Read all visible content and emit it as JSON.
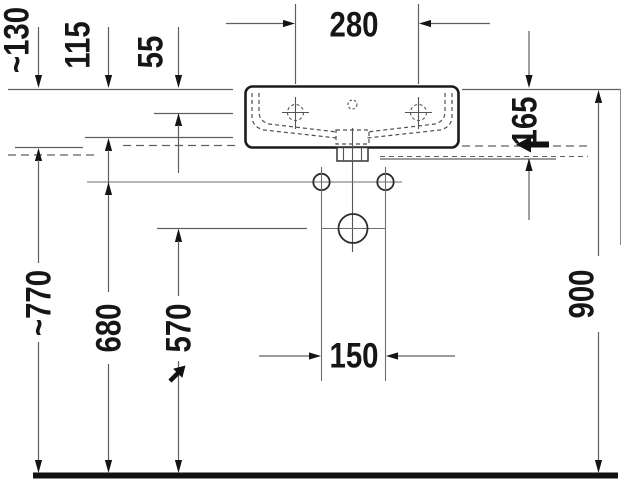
{
  "drawing": {
    "kind": "washbasin-installation-technical-drawing",
    "views": "front elevation with mounting and connection heights"
  },
  "dims": {
    "d130": "~130",
    "d115": "115",
    "d55": "55",
    "d280": "280",
    "d165": "165",
    "d900": "900",
    "d770": "~770",
    "d680": "680",
    "d570": "570",
    "d150": "150"
  },
  "colors": {
    "background": "#ffffff",
    "line": "#5f5f5f",
    "outline": "#1b1b1b",
    "text": "#161616",
    "floor": "#111111"
  }
}
